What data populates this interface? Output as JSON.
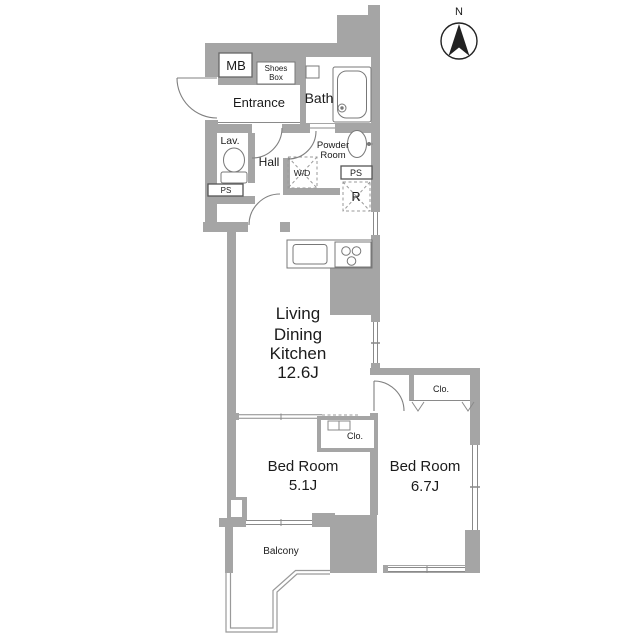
{
  "compass": {
    "label": "N"
  },
  "colors": {
    "wall": "#a5a5a5",
    "outline": "#8a8a8a",
    "fixture": "#777777",
    "text": "#1b1b1b"
  },
  "rooms": {
    "mb": {
      "label": "MB"
    },
    "shoes_box": {
      "line1": "Shoes",
      "line2": "Box"
    },
    "entrance": {
      "label": "Entrance"
    },
    "bath": {
      "label": "Bath"
    },
    "lavatory": {
      "label": "Lav."
    },
    "hall": {
      "label": "Hall"
    },
    "powder_room": {
      "line1": "Powder",
      "line2": "Room"
    },
    "washer_dryer": {
      "label": "W/D"
    },
    "pipe_space_left": {
      "label": "PS"
    },
    "pipe_space_right": {
      "label": "PS"
    },
    "refrigerator": {
      "label": "R"
    },
    "ldk": {
      "line1": "Living",
      "line2": "Dining",
      "line3": "Kitchen",
      "size": "12.6J"
    },
    "closet_bedroom1": {
      "label": "Clo."
    },
    "closet_bedroom2": {
      "label": "Clo."
    },
    "bedroom1": {
      "name": "Bed Room",
      "size": "5.1J"
    },
    "bedroom2": {
      "name": "Bed Room",
      "size": "6.7J"
    },
    "balcony": {
      "label": "Balcony"
    }
  }
}
